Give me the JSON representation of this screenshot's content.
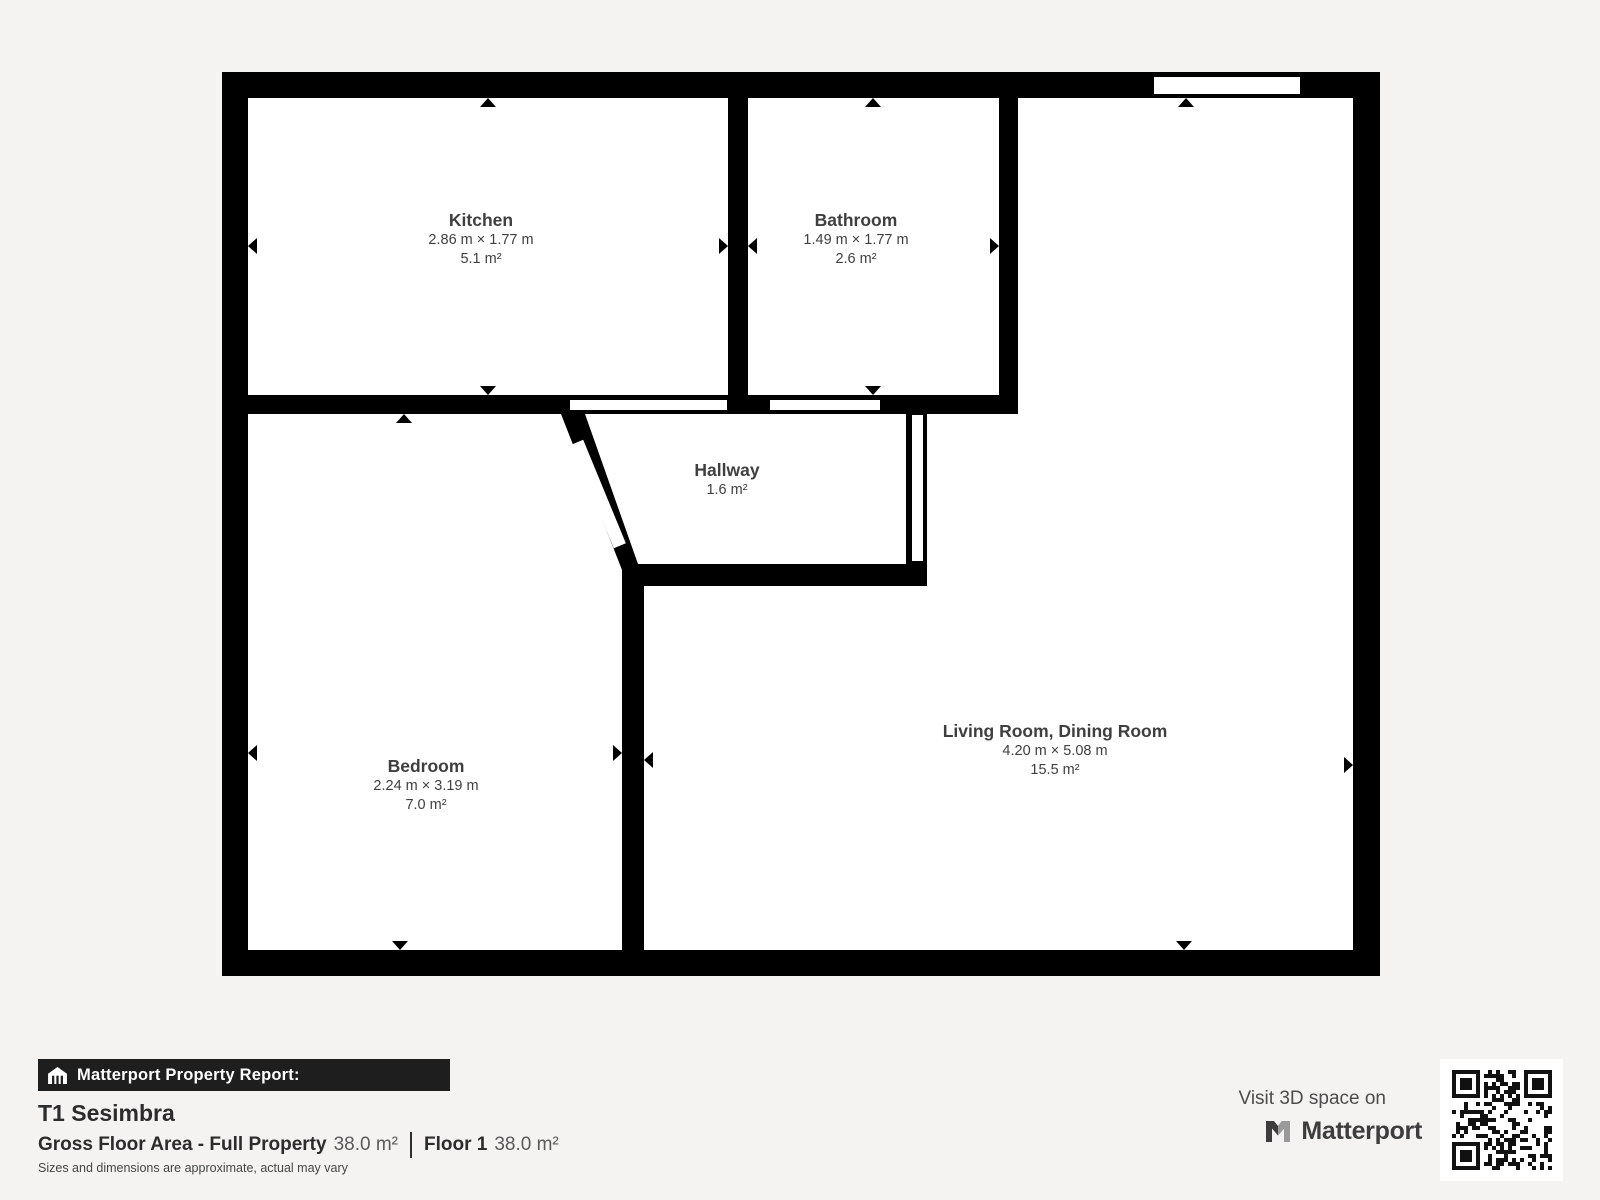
{
  "colors": {
    "background": "#f4f3f1",
    "wall": "#000000",
    "room_fill": "#ffffff",
    "bar_background": "#1e1e1e",
    "text_dark": "#2c2c2c",
    "room_text": "#3f3f3f"
  },
  "floorplan": {
    "rooms": [
      {
        "name": "Kitchen",
        "dimensions": "2.86 m × 1.77 m",
        "area": "5.1 m²"
      },
      {
        "name": "Bathroom",
        "dimensions": "1.49 m × 1.77 m",
        "area": "2.6 m²"
      },
      {
        "name": "Hallway",
        "area": "1.6 m²"
      },
      {
        "name": "Bedroom",
        "dimensions": "2.24 m × 3.19 m",
        "area": "7.0 m²"
      },
      {
        "name": "Living Room, Dining Room",
        "dimensions": "4.20 m × 5.08 m",
        "area": "15.5 m²"
      }
    ]
  },
  "footer": {
    "report_label": "Matterport Property Report:",
    "property_name": "T1 Sesimbra",
    "stats": {
      "gross_label": "Gross Floor Area - Full Property",
      "gross_value": "38.0 m²",
      "floor_label": "Floor 1",
      "floor_value": "38.0 m²"
    },
    "disclaimer": "Sizes and dimensions are approximate, actual may vary",
    "visit_3d": {
      "text": "Visit 3D space on",
      "brand": "Matterport"
    }
  }
}
